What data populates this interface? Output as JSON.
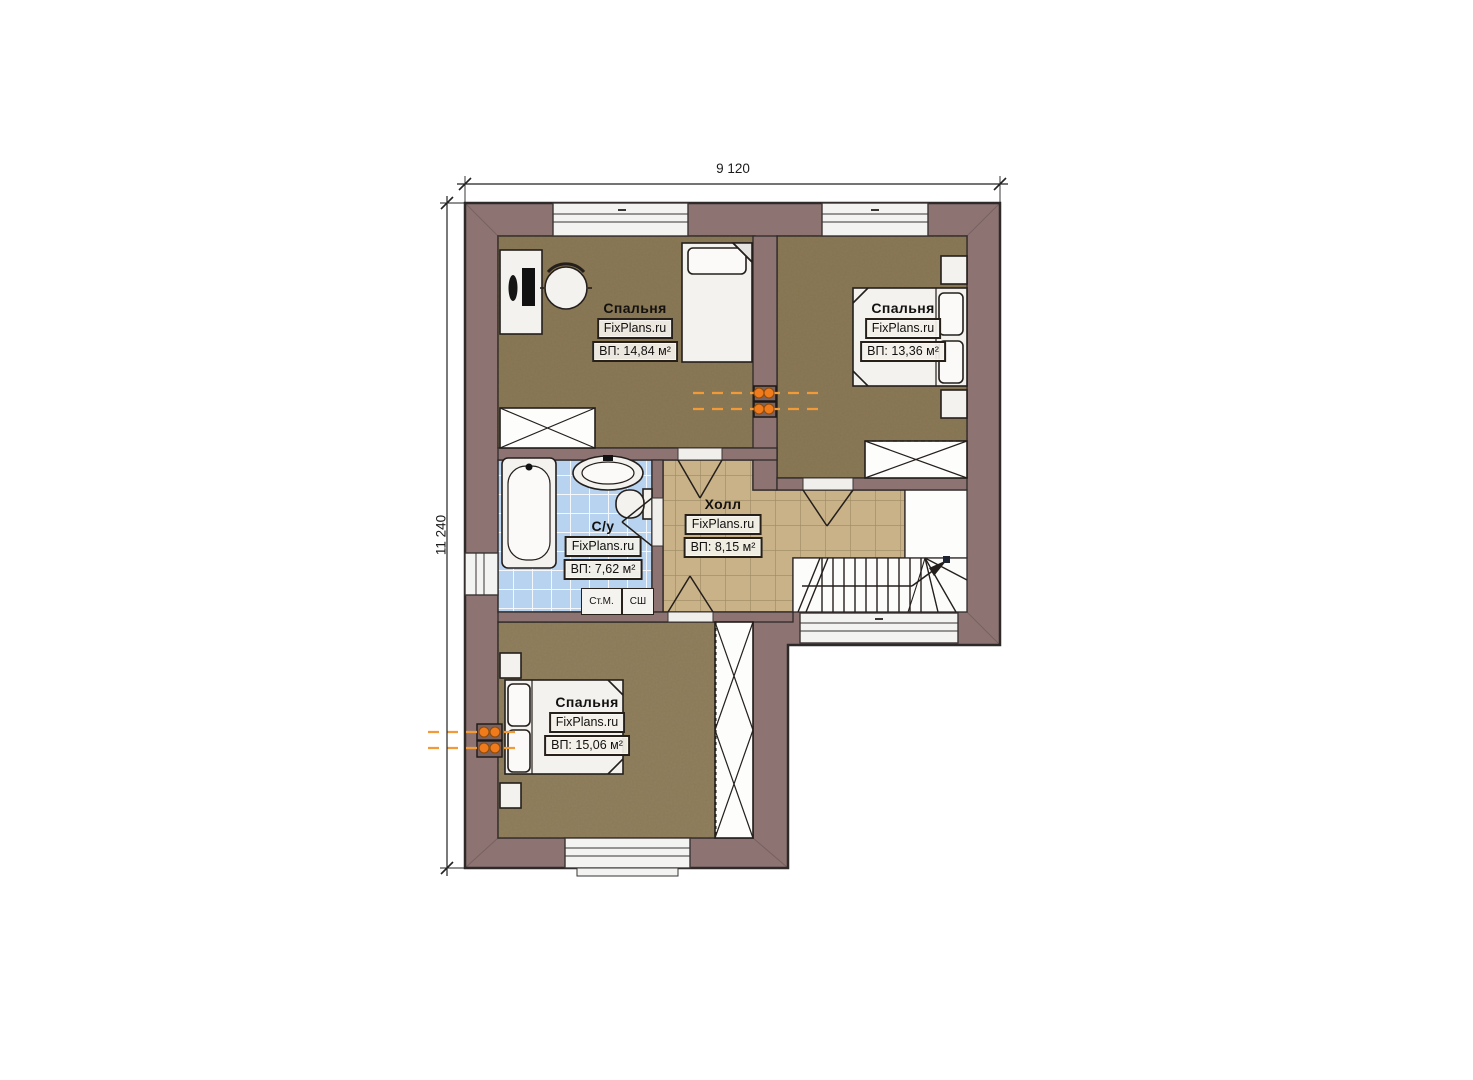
{
  "page": {
    "background": "#ffffff"
  },
  "dimensions": {
    "width_label": "9 120",
    "height_label": "11 240"
  },
  "rooms": [
    {
      "id": "bedroom-top-left",
      "name": "Спальня",
      "brand": "FixPlans.ru",
      "area": "ВП: 14,84 м²"
    },
    {
      "id": "bedroom-top-right",
      "name": "Спальня",
      "brand": "FixPlans.ru",
      "area": "ВП: 13,36 м²"
    },
    {
      "id": "bathroom",
      "name": "С/у",
      "brand": "FixPlans.ru",
      "area": "ВП: 7,62 м²"
    },
    {
      "id": "hall",
      "name": "Холл",
      "brand": "FixPlans.ru",
      "area": "ВП: 8,15 м²"
    },
    {
      "id": "bedroom-bottom",
      "name": "Спальня",
      "brand": "FixPlans.ru",
      "area": "ВП: 15,06 м²"
    }
  ],
  "appliances": {
    "washing_machine": "Ст.М.",
    "dryer": "СШ"
  },
  "colors": {
    "wall": "#8d7473",
    "bedroom_floor": "#8a7957",
    "bedroom_floor_light": "#90805f",
    "hall_tile": "#c9b287",
    "bath_tile": "#b7d3ef",
    "accent_orange": "#ef7b1c"
  }
}
